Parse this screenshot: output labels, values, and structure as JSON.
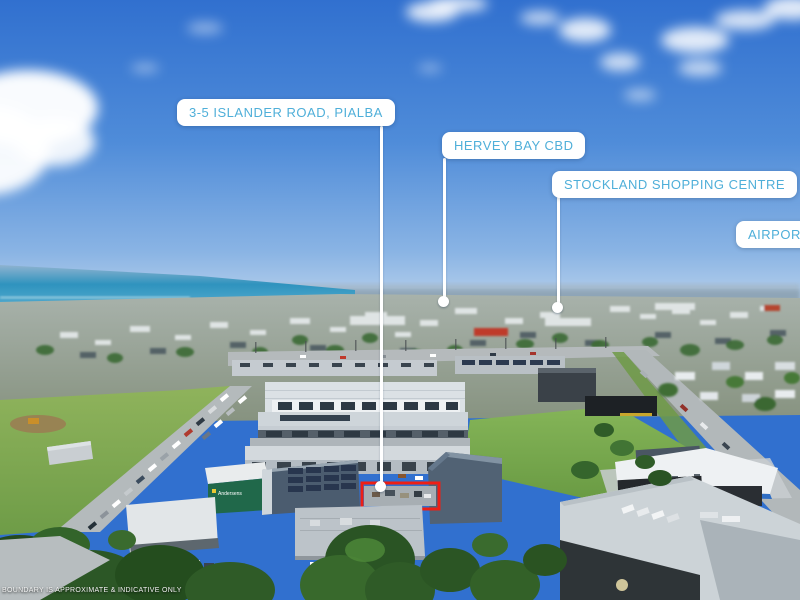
{
  "labels": {
    "property": "3-5 ISLANDER ROAD, PIALBA",
    "cbd": "HERVEY BAY CBD",
    "shopping": "STOCKLAND SHOPPING CENTRE",
    "airport": "AIRPORT"
  },
  "disclaimer": "BOUNDARY IS APPROXIMATE & INDICATIVE ONLY",
  "signage": {
    "andersens": "Andersens"
  },
  "colors": {
    "label_text": "#4fafd9",
    "label_bg": "#ffffff",
    "boundary_outline": "#ee1f14",
    "leader_line": "#ffffff",
    "sky_top": "#3170cf",
    "ocean": "#2f93be"
  },
  "icons": {
    "marker_dot": "white circular endpoint marker"
  }
}
